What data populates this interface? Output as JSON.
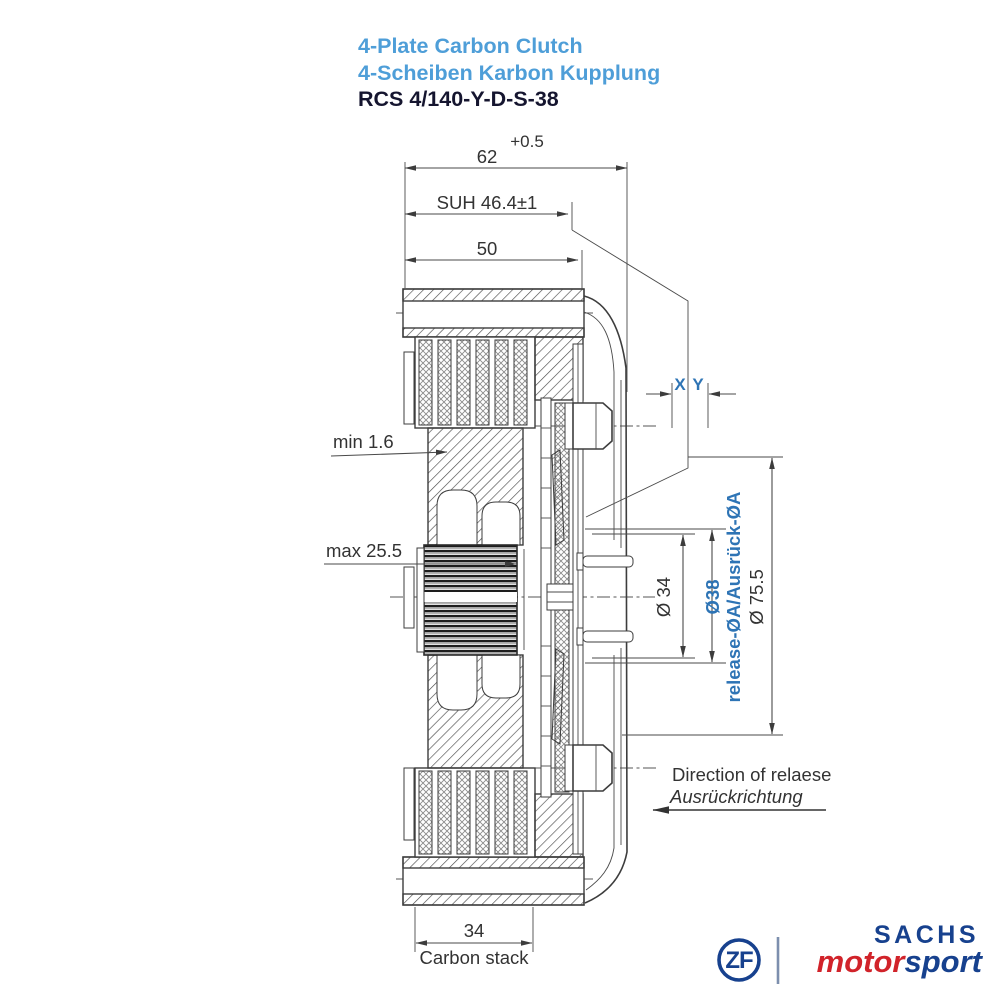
{
  "header": {
    "title_en": "4-Plate Carbon Clutch",
    "title_de": "4-Scheiben Karbon Kupplung",
    "part_number": "RCS 4/140-Y-D-S-38"
  },
  "dimensions": {
    "total_depth": {
      "tolerance": "+0.5",
      "value": "62"
    },
    "suh": "SUH 46.4±1",
    "depth_50": "50",
    "min_wear": "min 1.6",
    "max_wear": "max 25.5",
    "x_label": "X",
    "y_label": "Y",
    "dia_inner": "Ø 34",
    "dia_release": "Ø38",
    "dia_release_note": "release-ØA/Ausrück-ØA",
    "dia_outer": "Ø 75.5",
    "stack_width": "34",
    "stack_label": "Carbon stack",
    "release_dir_en": "Direction of relaese",
    "release_dir_de": "Ausrückrichtung"
  },
  "logo": {
    "zf": "ZF",
    "sachs": "SACHS",
    "motor": "motor",
    "sport": "sport"
  },
  "colors": {
    "title_blue": "#4e9ed8",
    "dim_blue": "#2e74b5",
    "line_gray": "#3d3d3d",
    "logo_blue": "#17418e",
    "logo_red": "#d1232a"
  }
}
